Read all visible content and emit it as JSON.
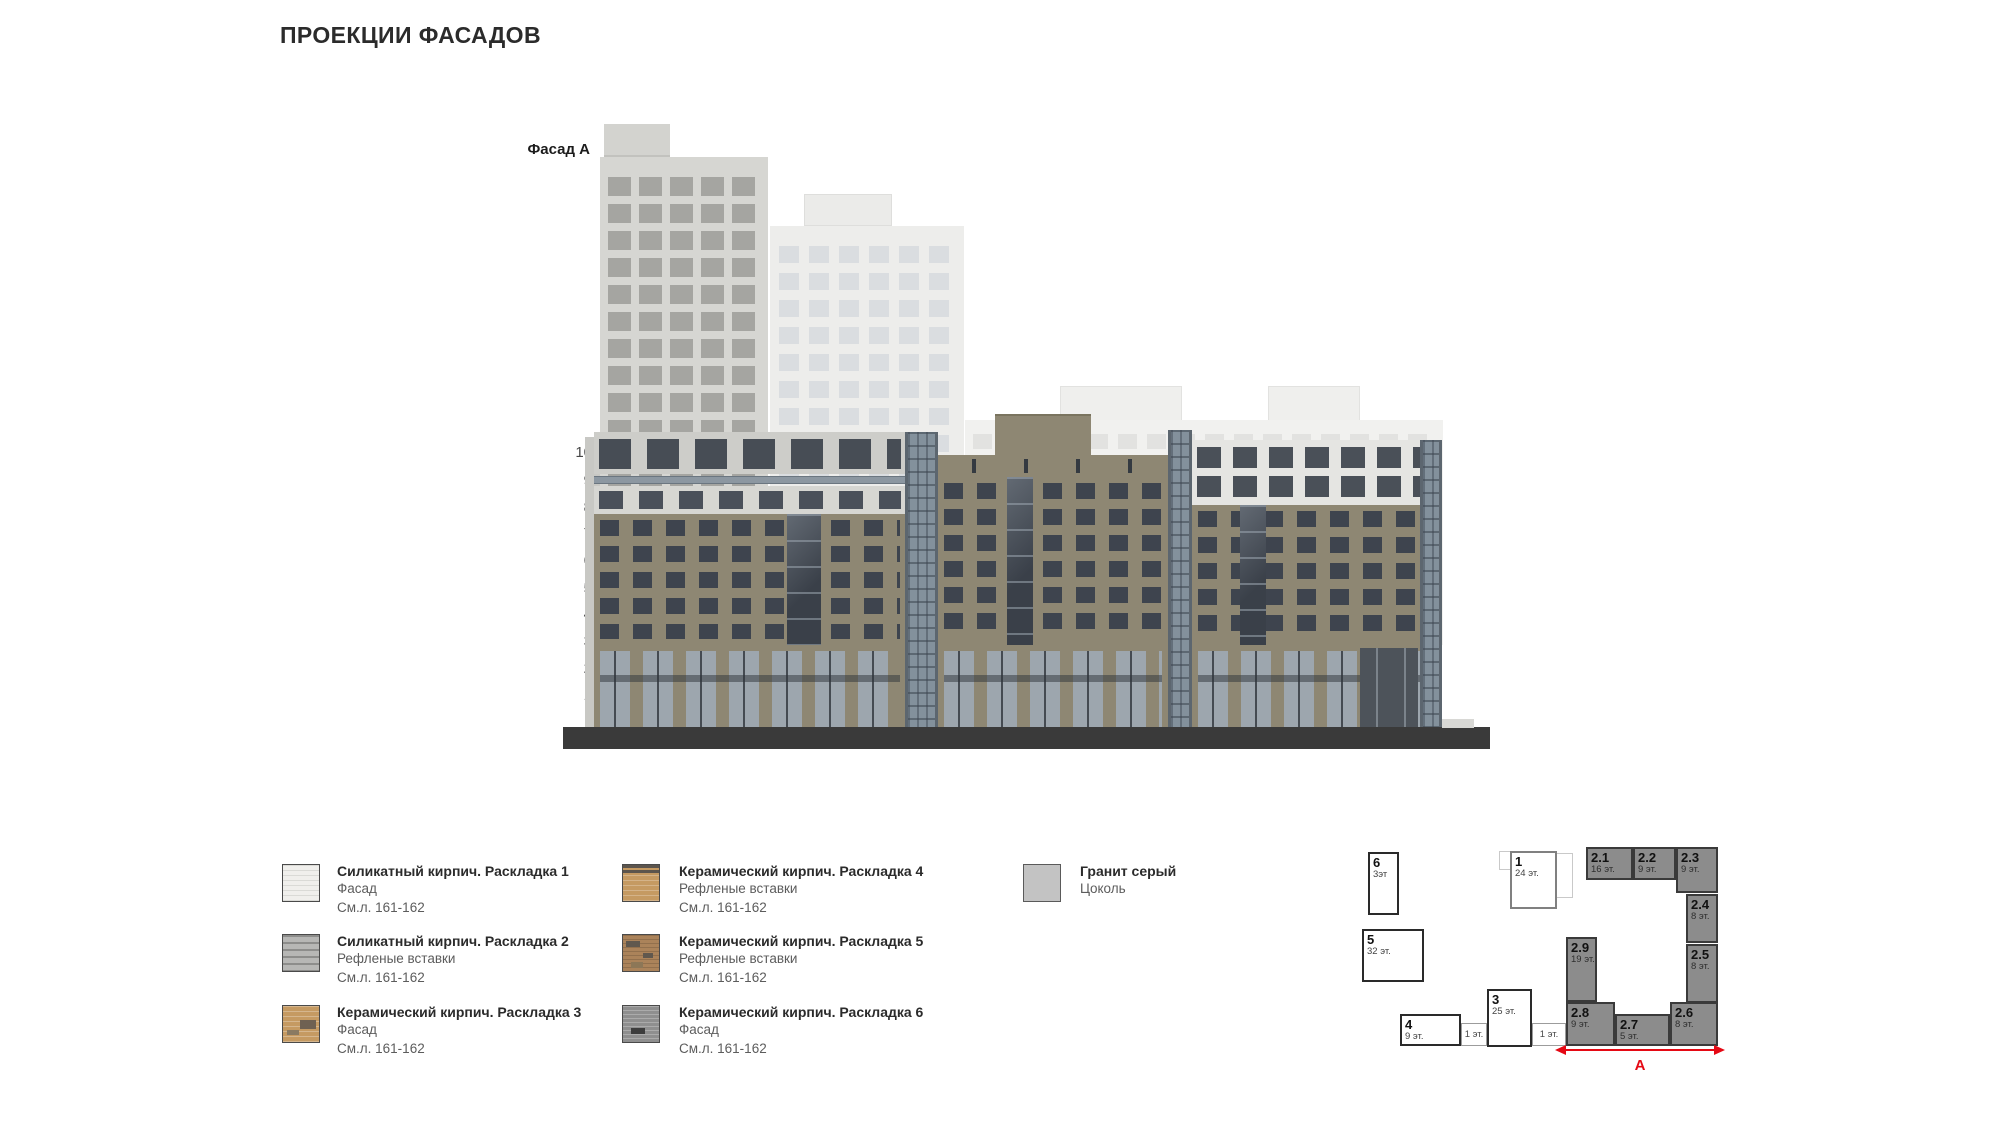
{
  "page": {
    "title": "ПРОЕКЦИИ ФАСАДОВ"
  },
  "facade": {
    "label": "Фасад А",
    "floor_numbers": [
      "10",
      "9",
      "8",
      "7",
      "6",
      "5",
      "4",
      "3",
      "2",
      "1"
    ]
  },
  "legend": {
    "items": [
      {
        "title": "Силикатный кирпич. Раскладка 1",
        "line2": "Фасад",
        "line3": "См.л. 161-162",
        "swatch": "silicate-brick-1"
      },
      {
        "title": "Силикатный кирпич. Раскладка 2",
        "line2": "Рефленые вставки",
        "line3": "См.л. 161-162",
        "swatch": "silicate-brick-2"
      },
      {
        "title": "Керамический кирпич. Раскладка 3",
        "line2": "Фасад",
        "line3": "См.л. 161-162",
        "swatch": "ceramic-brick-3"
      },
      {
        "title": "Керамический кирпич. Раскладка 4",
        "line2": "Рефленые вставки",
        "line3": "См.л. 161-162",
        "swatch": "ceramic-brick-4"
      },
      {
        "title": "Керамический кирпич. Раскладка 5",
        "line2": "Рефленые вставки",
        "line3": "См.л. 161-162",
        "swatch": "ceramic-brick-5"
      },
      {
        "title": "Керамический кирпич. Раскладка 6",
        "line2": "Фасад",
        "line3": "См.л. 161-162",
        "swatch": "ceramic-brick-6"
      },
      {
        "title": "Гранит серый",
        "line2": "Цоколь",
        "line3": "",
        "swatch": "granite-gray"
      }
    ]
  },
  "site_plan": {
    "white_blocks": [
      {
        "id": "6",
        "floors": "3эт"
      },
      {
        "id": "5",
        "floors": "32 эт."
      },
      {
        "id": "1",
        "floors": "24 эт."
      },
      {
        "id": "4",
        "floors": "9 эт."
      },
      {
        "id": "3",
        "floors": "25 эт."
      }
    ],
    "low_blocks": [
      {
        "label": "1 эт."
      },
      {
        "label": "1 эт."
      }
    ],
    "gray_blocks": [
      {
        "id": "2.1",
        "floors": "16 эт."
      },
      {
        "id": "2.2",
        "floors": "9 эт."
      },
      {
        "id": "2.3",
        "floors": "9 эт."
      },
      {
        "id": "2.4",
        "floors": "8 эт."
      },
      {
        "id": "2.5",
        "floors": "8 эт."
      },
      {
        "id": "2.6",
        "floors": "8 эт."
      },
      {
        "id": "2.7",
        "floors": "5 эт."
      },
      {
        "id": "2.8",
        "floors": "9 эт."
      },
      {
        "id": "2.9",
        "floors": "19 эт."
      }
    ],
    "dimension_label": "А"
  },
  "colors": {
    "accent_red": "#e50914",
    "facade_brown": "#8e8773",
    "silicate_light": "#f0efec",
    "silicate_gray": "#b7b7b5",
    "ceramic_tan": "#c59a62",
    "ceramic_dark": "#8f8f8f",
    "granite_gray": "#c3c3c3",
    "base_dark": "#3a3a3a",
    "plan_gray": "#8c8c8c"
  }
}
